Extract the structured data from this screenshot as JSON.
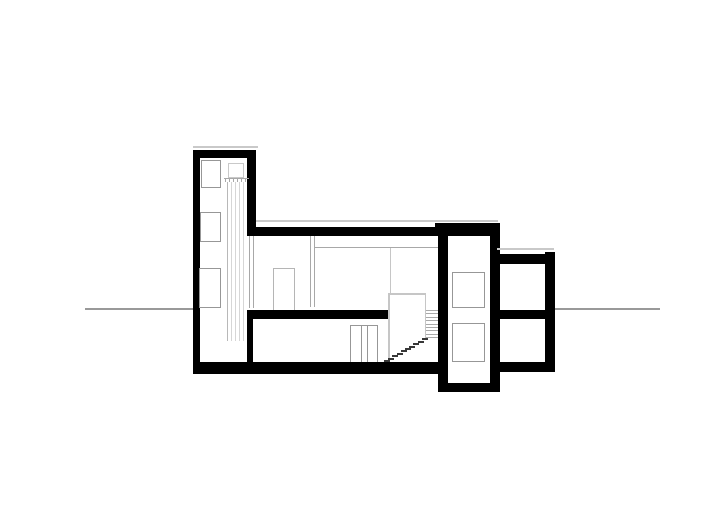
{
  "meta": {
    "drawing_type": "architectural building cross-section (black poché walls on white)",
    "visible_text": "none"
  },
  "colors": {
    "background": "#ffffff",
    "wall": "#000000",
    "ground_line": "#999999",
    "window_outline": "#979797",
    "face_line": "#a8a8a8",
    "light_line": "#c9c9c9",
    "duct_line": "#d6d6d6",
    "tread_line": "#a9a9a9",
    "step": "#383838"
  },
  "drawing": {
    "tower_window_count": 3,
    "stairwell_window_count": 2,
    "flue": {
      "line_count": 5
    },
    "stair": {
      "diagonal_steps": 10,
      "tread_lines": 9
    },
    "ground_line_y": 309
  }
}
